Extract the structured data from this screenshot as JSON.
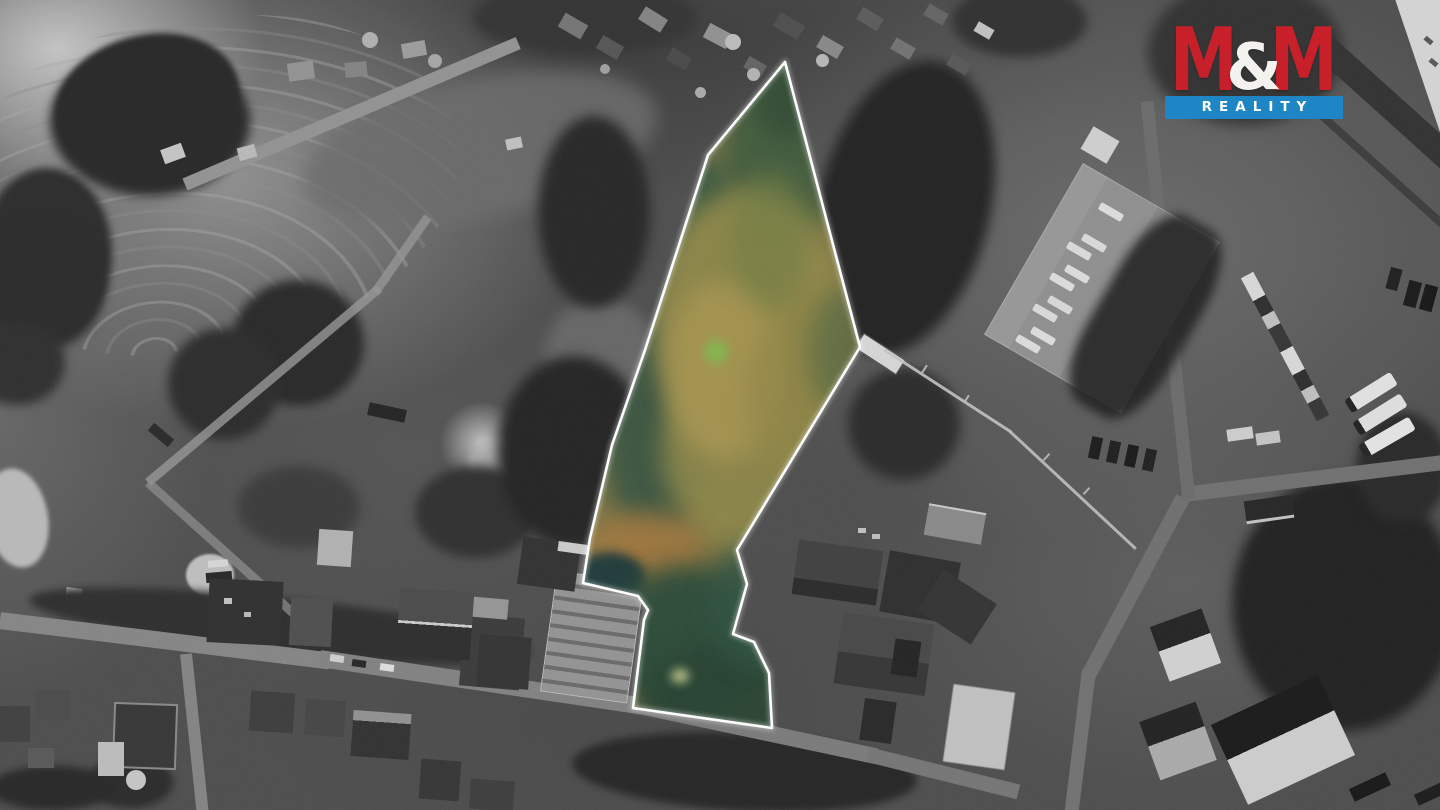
{
  "page": {
    "kind": "real-estate aerial listing photo",
    "width_px": 1440,
    "height_px": 810
  },
  "logo": {
    "m1": "M",
    "ampersand": "&",
    "m2": "M",
    "subtitle": "REALITY",
    "red": "#c8202a",
    "blue": "#1f86c6",
    "subtitle_color": "#ffffff"
  },
  "map": {
    "style": "black-and-white aerial / satellite photograph, surroundings desaturated",
    "parcel": {
      "label": "highlighted land parcel (shown in color)",
      "outline_color": "#ffffff",
      "points_svg": "785,62 860,347 737,550 747,584 733,634 754,642 769,673 772,728 633,708 644,620 648,610 638,596 583,583 590,538 612,445 645,350 708,155",
      "fill_colors": [
        "#7d7545",
        "#948a49",
        "#ab9751",
        "#a0773e",
        "#335440",
        "#33513f",
        "#16343a",
        "#2c4a38"
      ]
    }
  }
}
